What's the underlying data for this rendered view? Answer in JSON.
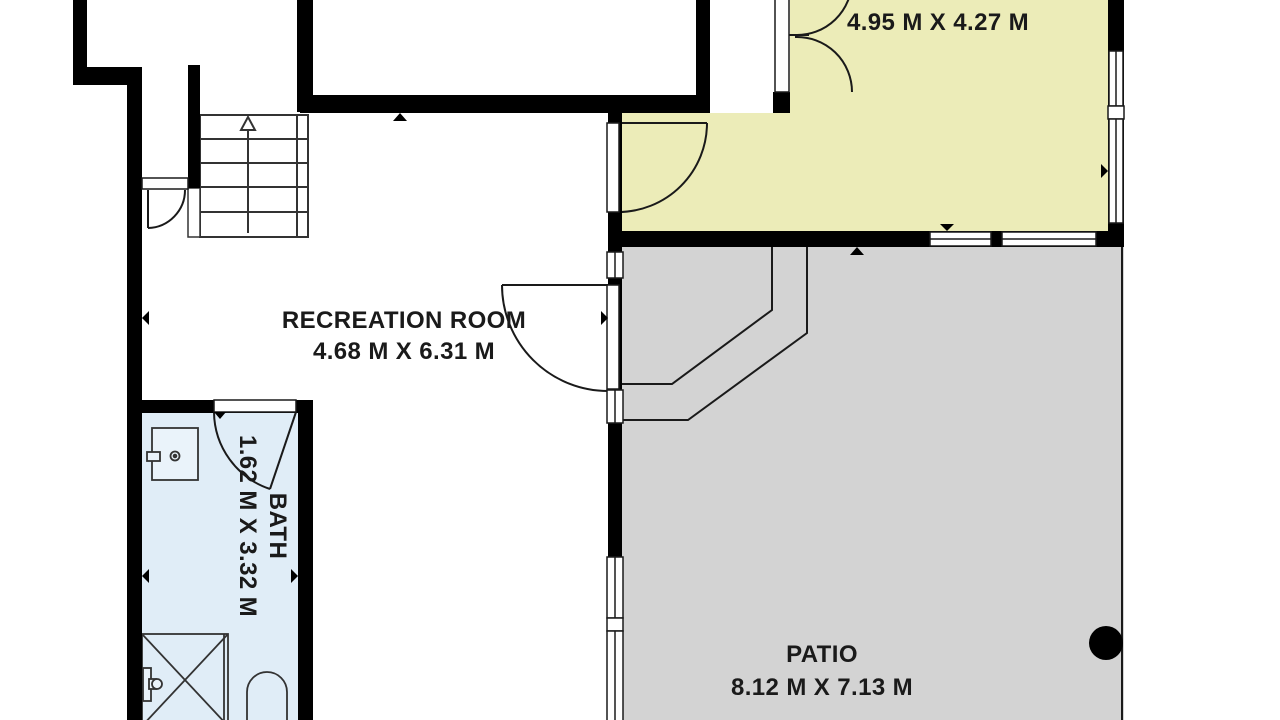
{
  "plan_type": "floor-plan",
  "rooms": {
    "bedroom": {
      "name": "BEDROOM",
      "dims": "4.95 M X 4.27 M"
    },
    "recreation": {
      "name": "RECREATION ROOM",
      "dims": "4.68 M X 6.31 M"
    },
    "bath": {
      "name": "BATH",
      "dims": "1.62 M X 3.32 M"
    },
    "patio": {
      "name": "PATIO",
      "dims": "8.12 M X 7.13 M"
    }
  },
  "colors": {
    "bedroom_fill": "#ECECB8",
    "bath_fill": "#E0EDF7",
    "patio_fill": "#D3D3D3",
    "wall": "#000000",
    "line": "#1a1a1a",
    "text": "#1a1a1a",
    "background": "#FFFFFF"
  },
  "features": {
    "stairs": "staircase with up-arrow, 5 treads",
    "doors": [
      "hall-door",
      "bath-door",
      "bedroom-door",
      "patio-door",
      "bedroom-double-door"
    ],
    "fixtures": [
      "vanity-sink",
      "shower",
      "toilet"
    ],
    "patio_marker": "black column dot"
  }
}
